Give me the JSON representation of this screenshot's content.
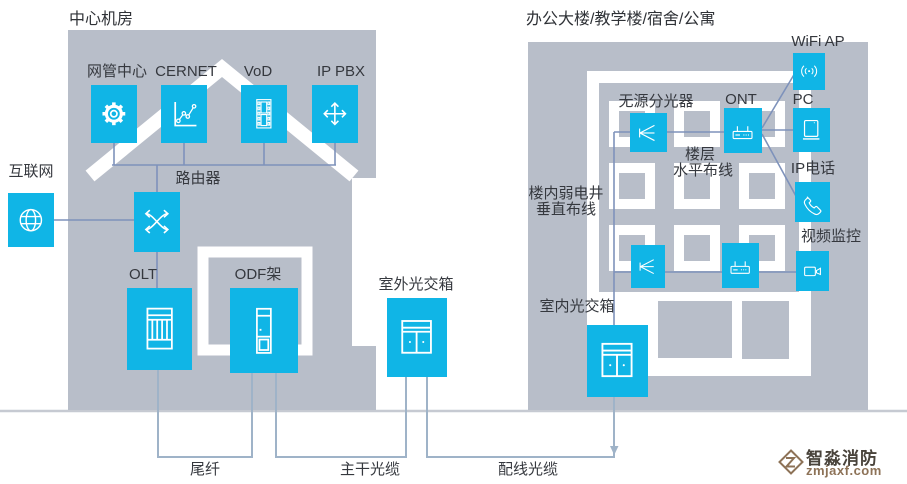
{
  "left_building": {
    "title": "中心机房",
    "devices": {
      "nmc": {
        "label": "网管中心",
        "icon": "gear-icon"
      },
      "cernet": {
        "label": "CERNET",
        "icon": "chart-icon"
      },
      "vod": {
        "label": "VoD",
        "icon": "film-icon"
      },
      "ippbx": {
        "label": "IP PBX",
        "icon": "cross-arrows-icon"
      },
      "router": {
        "label": "路由器",
        "icon": "switch-icon"
      },
      "olt": {
        "label": "OLT",
        "icon": "rack-icon"
      },
      "odf": {
        "label": "ODF架",
        "icon": "cabinet-tall-icon"
      }
    }
  },
  "internet": {
    "label": "互联网",
    "icon": "globe-icon"
  },
  "outdoor_box": {
    "label": "室外光交箱",
    "icon": "cross-connect-cabinet-icon"
  },
  "right_building": {
    "title": "办公大楼/教学楼/宿舍/公寓",
    "devices": {
      "splitter": {
        "label": "无源分光器",
        "icon": "splitter-icon"
      },
      "ont": {
        "label": "ONT",
        "icon": "ont-router-icon"
      },
      "wifi_ap": {
        "label": "WiFi AP",
        "icon": "wifi-icon"
      },
      "pc": {
        "label": "PC",
        "icon": "monitor-icon"
      },
      "ip_phone": {
        "label": "IP电话",
        "icon": "phone-icon"
      },
      "cctv": {
        "label": "视频监控",
        "icon": "video-camera-icon"
      },
      "indoor_box": {
        "label": "室内光交箱",
        "icon": "cross-connect-cabinet-icon"
      }
    },
    "annotations": {
      "floor_wiring": {
        "line1": "楼层",
        "line2": "水平布线"
      },
      "riser": {
        "line1": "楼内弱电井",
        "line2": "垂直布线"
      }
    }
  },
  "cables": {
    "pigtail": "尾纤",
    "trunk": "主干光缆",
    "distribution": "配线光缆"
  },
  "watermark": {
    "brand": "智淼消防",
    "domain": "zmjaxf.com"
  },
  "colors": {
    "accent_cyan": "#10b5e6",
    "building_gray": "#b8bec9",
    "connector_blue": "#7e92bb",
    "cable_gray": "#9fb3c8",
    "ground_gray": "#c6cad2",
    "text_dark": "#35383e",
    "watermark_brown": "#8d7257"
  }
}
